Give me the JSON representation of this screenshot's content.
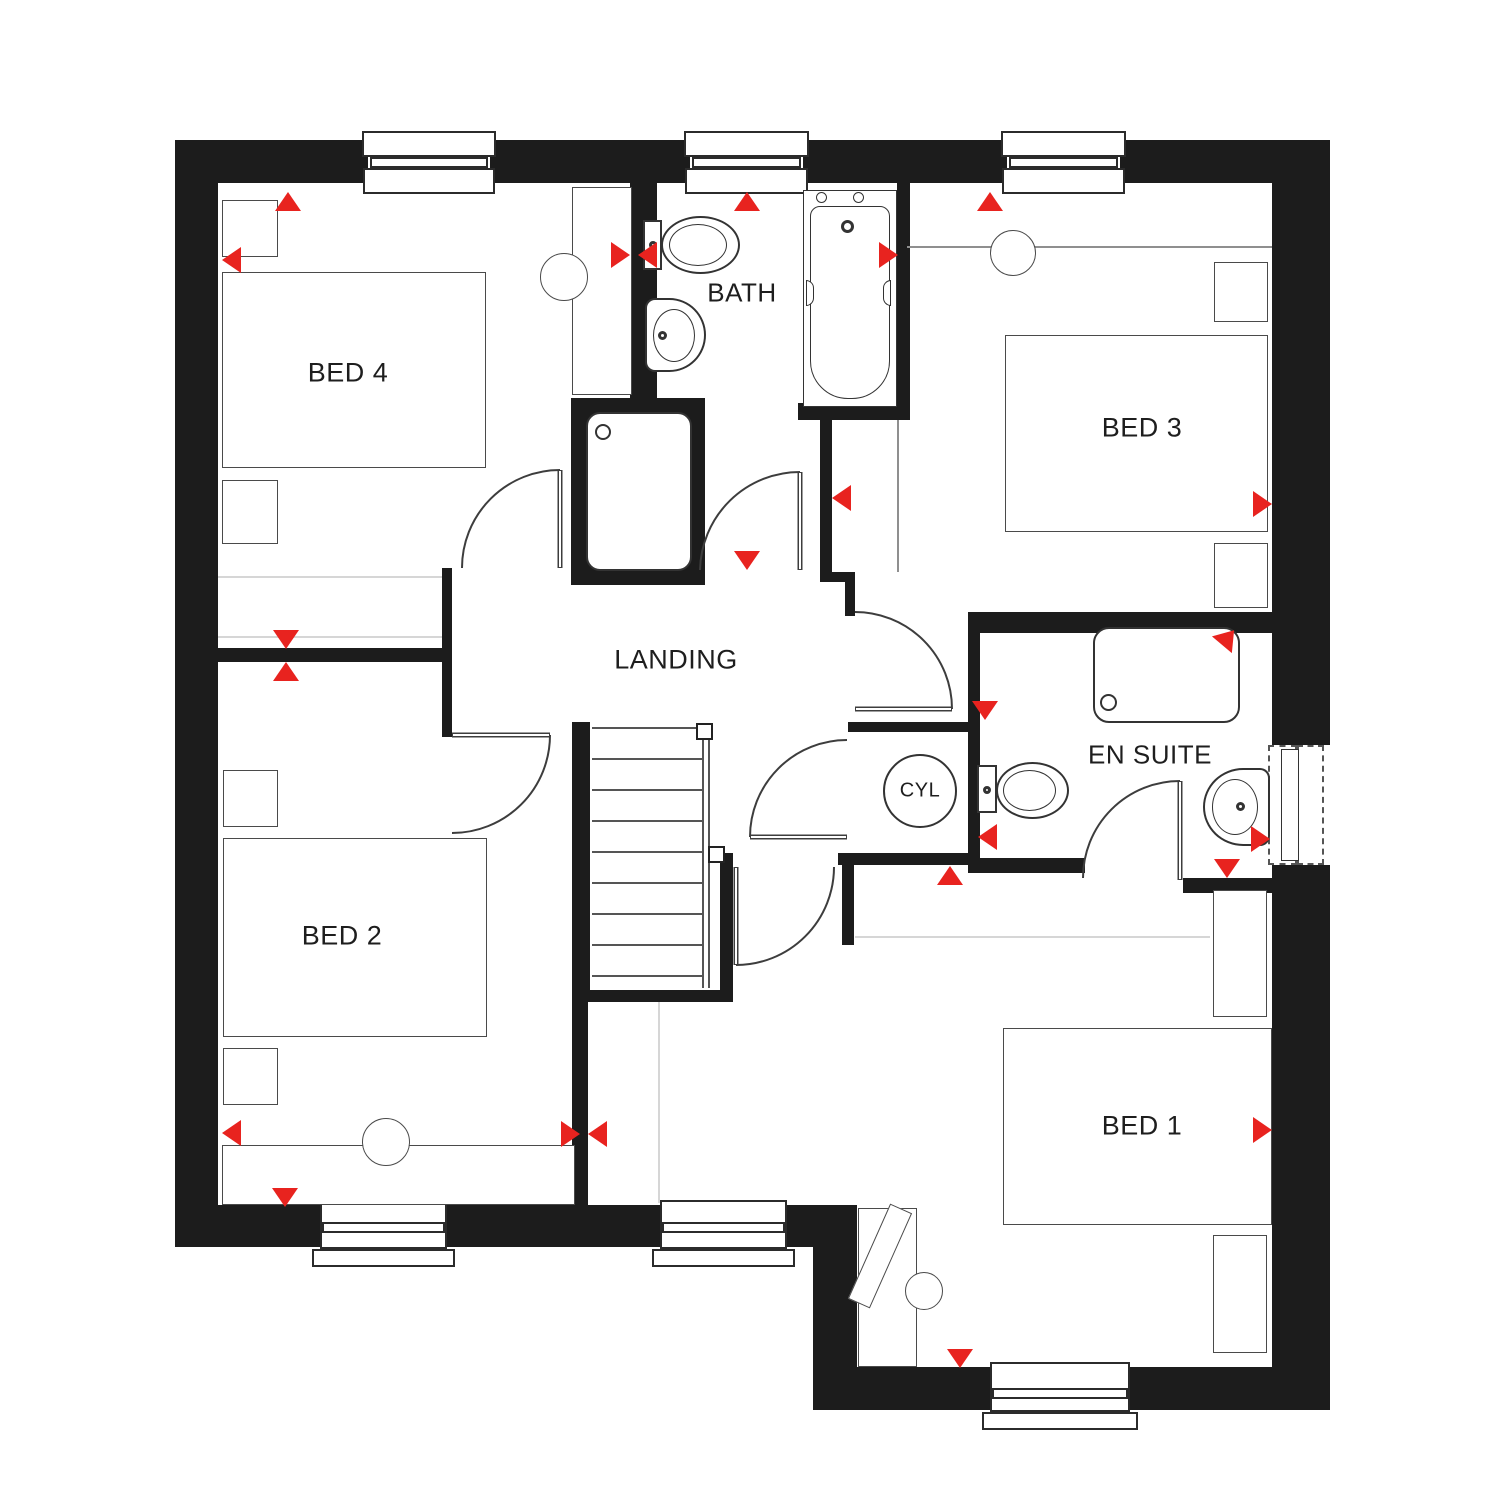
{
  "title": "First floor plan",
  "colors": {
    "wall": "#1c1c1c",
    "red": "#e8231f",
    "line": "#3d3d3d",
    "light": "#d6d6d6"
  },
  "rooms": {
    "bed1": {
      "label": "BED 1"
    },
    "bed2": {
      "label": "BED 2"
    },
    "bed3": {
      "label": "BED 3"
    },
    "bed4": {
      "label": "BED 4"
    },
    "bath": {
      "label": "BATH"
    },
    "ensuite": {
      "label": "EN SUITE"
    },
    "landing": {
      "label": "LANDING"
    },
    "cylinder": {
      "label": "CYL"
    }
  }
}
